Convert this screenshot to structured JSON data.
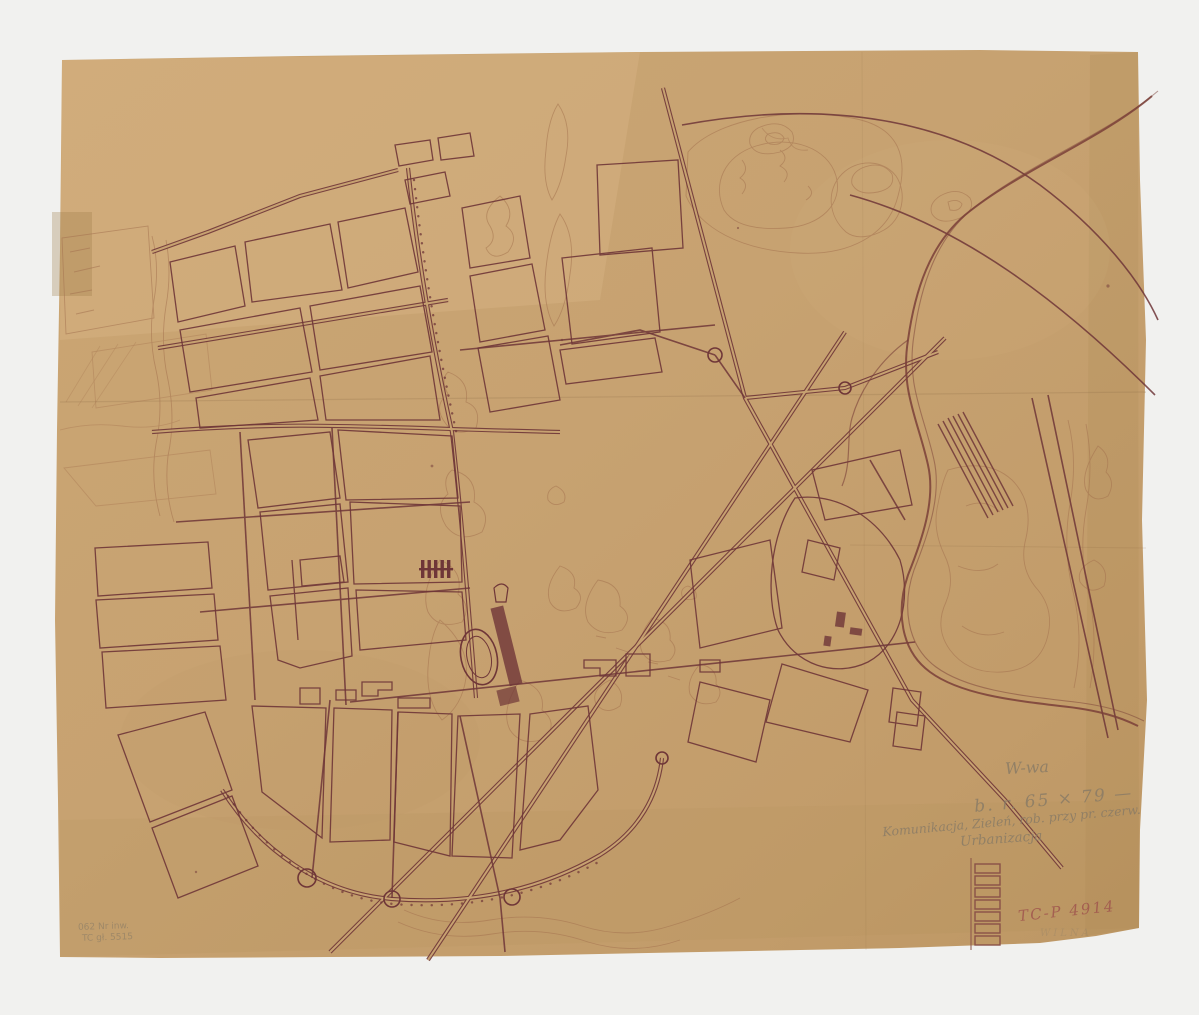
{
  "annotations": {
    "city_abbrev": "W-wa",
    "size_note": "b. r. 65 × 79 —",
    "subject_note_line1": "Komunikacja, Zieleń, rob. przy pr. czerw.",
    "subject_note_line2": "Urbanizacja",
    "catalog_number_red": "TC-P 4914",
    "faint_stamp": "WILNA",
    "inventory_line1": "062 Nr inw.",
    "inventory_line2": "TC gł. 5515"
  },
  "legend": {
    "box_count": 7,
    "description": "vertical ladder of small rectangles drawn at lower right of sheet"
  },
  "palette": {
    "scanner_background": "#f1f1ef",
    "paper": "#c7a271",
    "paper_light": "#d8b486",
    "paper_shadow": "#a8854f",
    "ink": "#6f3638",
    "sketch_ink": "#a4724f",
    "pencil": "#877a66",
    "red_pencil": "#a0564e"
  }
}
